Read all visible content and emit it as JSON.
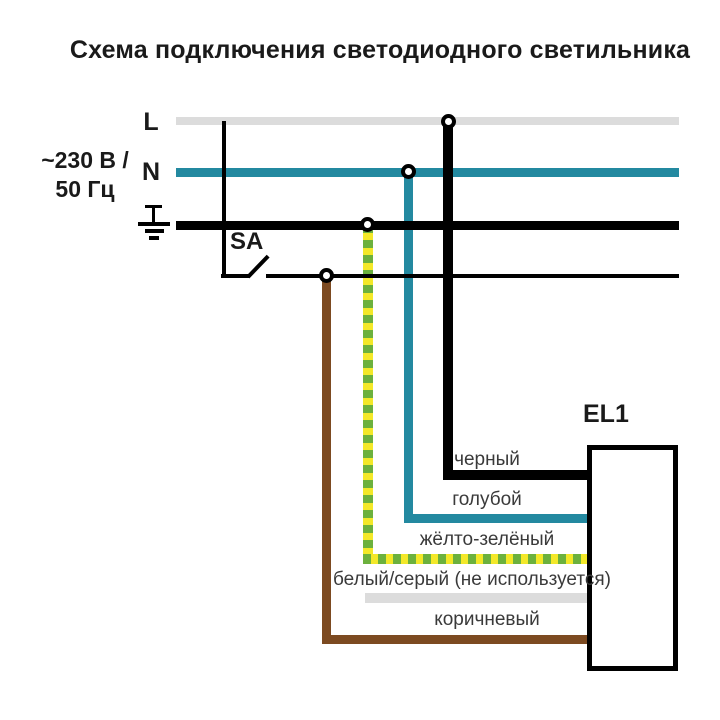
{
  "title": "Схема подключения светодиодного светильника",
  "power": {
    "rating_line1": "~230 В /",
    "rating_line2": "50 Гц",
    "line_label": "L",
    "neutral_label": "N"
  },
  "switch": {
    "label": "SA"
  },
  "luminaire": {
    "label": "EL1"
  },
  "wire_labels": {
    "black": "черный",
    "blue": "голубой",
    "yellow_green": "жёлто-зелёный",
    "white_gray": "белый/серый (не используется)",
    "brown": "коричневый"
  },
  "colors": {
    "line_bus_gray": "#dcdcdc",
    "neutral_teal": "#2389a0",
    "pe_black": "#000000",
    "pe_yellow": "#f3e829",
    "pe_green": "#6cb13d",
    "unused_gray": "#dcdcdc",
    "brown": "#7c4a21",
    "title_text": "#1a1a1a",
    "label_text": "#3a3a3a"
  }
}
